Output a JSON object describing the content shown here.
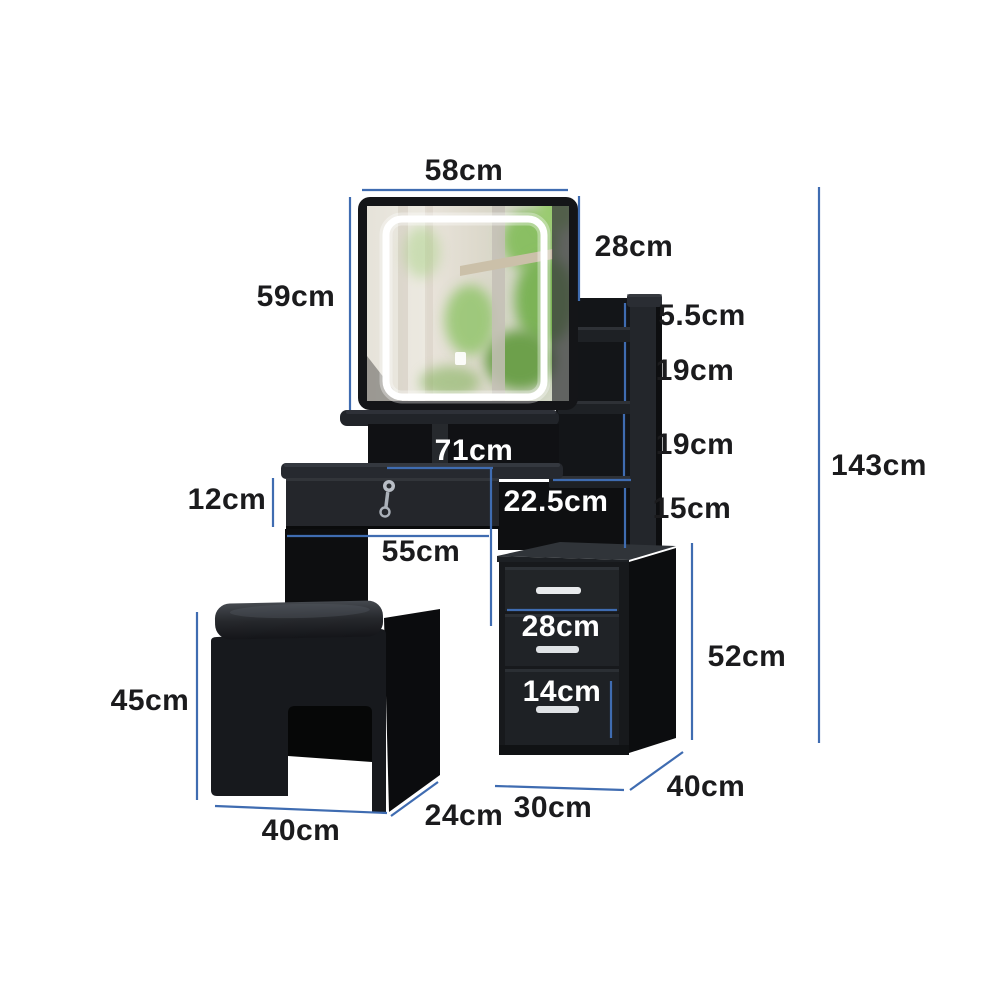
{
  "diagram": {
    "product": "LED vanity dressing table set with mirror, storage shelves, lockable drawer, three-drawer cabinet and stool",
    "unit": "cm",
    "accent_line_color": "#3f6cb1",
    "label_text_color": "#1b1b1d",
    "label_text_color_on_dark": "#ffffff",
    "furniture_color": "#17191c",
    "background_color": "#ffffff"
  },
  "dimensions": {
    "mirror_width": "58cm",
    "mirror_to_shelf_height": "28cm",
    "mirror_height": "59cm",
    "top_shelf_gap": "5.5cm",
    "shelf_gap_upper": "19cm",
    "shelf_gap_lower": "19cm",
    "total_height": "143cm",
    "desktop_width": "71cm",
    "shelf_inner_width": "22.5cm",
    "bottom_shelf_gap": "15cm",
    "desk_drawer_height": "12cm",
    "knee_space_width": "55cm",
    "cabinet_drawer_width": "28cm",
    "cabinet_height": "52cm",
    "cabinet_drawer_height": "14cm",
    "stool_height": "45cm",
    "stool_width": "40cm",
    "stool_depth": "24cm",
    "cabinet_width": "30cm",
    "cabinet_depth": "40cm"
  }
}
